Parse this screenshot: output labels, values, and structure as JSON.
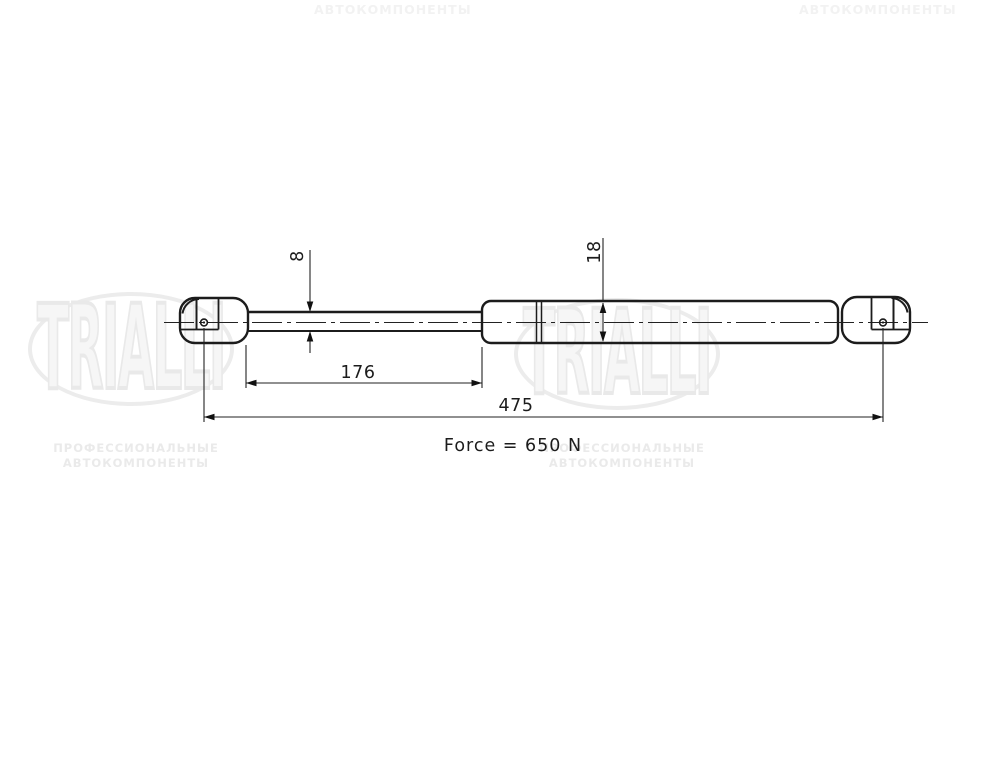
{
  "watermarks": {
    "top_center_text": "АВТОКОМПОНЕНТЫ",
    "top_right_text": "АВТОКОМПОНЕНТЫ",
    "brand": "TRIALLI",
    "tagline_line1": "ПРОФЕССИОНАЛЬНЫЕ",
    "tagline_line2": "АВТОКОМПОНЕНТЫ"
  },
  "drawing": {
    "force_label": "Force = 650 N",
    "dims": {
      "rod_diameter": "8",
      "body_diameter": "18",
      "rod_length": "176",
      "total_length": "475"
    },
    "colors": {
      "line": "#1c1c1c",
      "watermark": "#ececec",
      "background": "#ffffff"
    }
  }
}
